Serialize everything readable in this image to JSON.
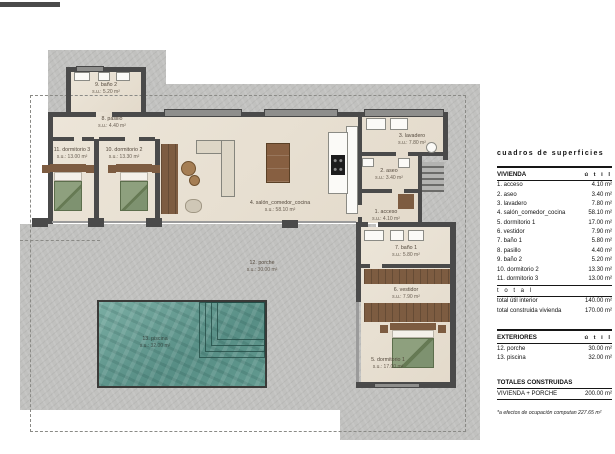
{
  "colors": {
    "concrete": "#c1c1bf",
    "floor": "#e9e1d4",
    "wall": "#4a4a4a",
    "pool_water": "#5f968d",
    "wood": "#7d5c41",
    "bedding_green": "#87997a",
    "label_text": "#54493d"
  },
  "plan": {
    "rooms": {
      "acceso": {
        "name": "1. acceso",
        "area": "s.u.: 4.10 m²"
      },
      "aseo": {
        "name": "2. aseo",
        "area": "s.u.: 3.40 m²"
      },
      "lavadero": {
        "name": "3. lavadero",
        "area": "s.u.: 7.80 m²"
      },
      "salon": {
        "name": "4. salón_comedor_cocina",
        "area": "s.u.: 58.10 m²"
      },
      "dormitorio1": {
        "name": "5. dormitorio 1",
        "area": "s.u.: 17.00 m²"
      },
      "vestidor": {
        "name": "6. vestidor",
        "area": "s.u.: 7.90 m²"
      },
      "bano1": {
        "name": "7. baño 1",
        "area": "s.u.: 5.80 m²"
      },
      "pasillo": {
        "name": "8. pasillo",
        "area": "s.u.: 4.40 m²"
      },
      "bano2": {
        "name": "9. baño 2",
        "area": "s.u.: 5.20 m²"
      },
      "dormitorio2": {
        "name": "10. dormitorio 2",
        "area": "s.u.: 13.30 m²"
      },
      "dormitorio3": {
        "name": "11. dormitorio 3",
        "area": "s.u.: 13.00 m²"
      },
      "porche": {
        "name": "12. porche",
        "area": "s.u.: 30.00 m²"
      },
      "piscina": {
        "name": "13. piscina",
        "area": "s.u.: 32.00 m²"
      }
    }
  },
  "table": {
    "title": "cuadros de superficies",
    "vivienda": {
      "header": "VIVIENDA",
      "unit_col": "ú t i l",
      "rows": [
        {
          "label": "1. acceso",
          "value": "4.10 m²"
        },
        {
          "label": "2. aseo",
          "value": "3.40 m²"
        },
        {
          "label": "3. lavadero",
          "value": "7.80 m²"
        },
        {
          "label": "4. salón_comedor_cocina",
          "value": "58.10 m²"
        },
        {
          "label": "5. dormitorio 1",
          "value": "17.00 m²"
        },
        {
          "label": "6. vestidor",
          "value": "7.90 m²"
        },
        {
          "label": "7. baño 1",
          "value": "5.80 m²"
        },
        {
          "label": "8. pasillo",
          "value": "4.40 m²"
        },
        {
          "label": "9. baño 2",
          "value": "5.20 m²"
        },
        {
          "label": "10. dormitorio 2",
          "value": "13.30 m²"
        },
        {
          "label": "11. dormitorio 3",
          "value": "13.00 m²"
        }
      ],
      "total_divider": "t o t a l",
      "totals": [
        {
          "label": "total útil interior",
          "value": "140.00 m²"
        },
        {
          "label": "total construida vivienda",
          "value": "170.00 m²"
        }
      ]
    },
    "exteriores": {
      "header": "EXTERIORES",
      "unit_col": "ú t i l",
      "rows": [
        {
          "label": "12. porche",
          "value": "30.00 m²"
        },
        {
          "label": "13. piscina",
          "value": "32.00 m²"
        }
      ]
    },
    "totales": {
      "header": "TOTALES CONSTRUIDAS",
      "rows": [
        {
          "label": "VIVIENDA + PORCHE",
          "value": "200.00 m²"
        }
      ]
    },
    "footnote": "*a efectos de ocupación computan 227.65 m²"
  }
}
